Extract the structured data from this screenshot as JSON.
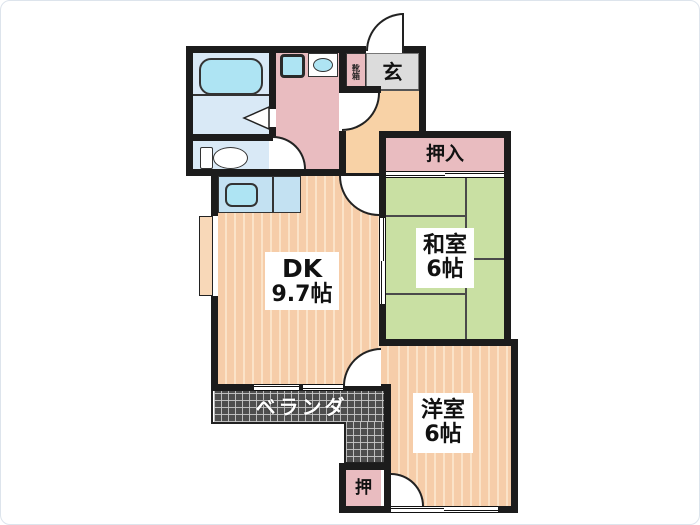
{
  "rooms": {
    "dk": {
      "name": "DK",
      "size": "9.7帖"
    },
    "washitsu": {
      "name": "和室",
      "size": "6帖"
    },
    "youshitsu": {
      "name": "洋室",
      "size": "6帖"
    },
    "oshiire": {
      "label": "押入"
    },
    "oshi": {
      "label": "押"
    },
    "genkan": {
      "label": "玄"
    },
    "kutsubako": {
      "label": "靴箱"
    },
    "veranda": {
      "label": "ベランダ"
    }
  },
  "colors": {
    "wall": "#1c1c1c",
    "bath_floor": "#d9e9f6",
    "closet_pink": "#e9bcc0",
    "genkan_gray": "#dcdcdc",
    "hall_peach": "#f8d2a6",
    "dk_base": "#f6cda9",
    "dk_stripe": "#fbe3c8",
    "tatami_green": "#c9e0a3",
    "veranda_dark": "#4e4e4e",
    "fixture_cyan": "#aee4f3",
    "counter_blue": "#c3e1f2"
  }
}
